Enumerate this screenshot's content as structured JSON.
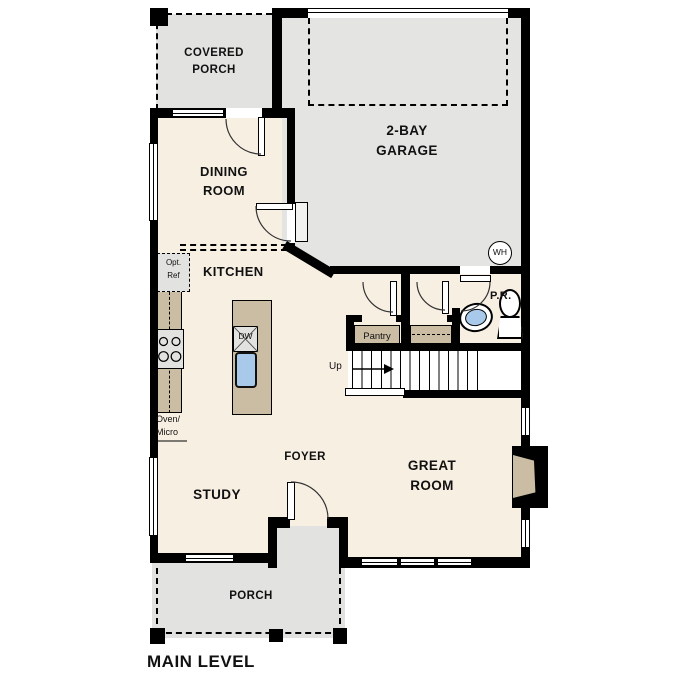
{
  "title": "MAIN LEVEL",
  "rooms": {
    "covered_porch": {
      "line1": "COVERED",
      "line2": "PORCH"
    },
    "garage": {
      "line1": "2-BAY",
      "line2": "GARAGE"
    },
    "dining": {
      "line1": "DINING",
      "line2": "ROOM"
    },
    "kitchen": {
      "label": "KITCHEN"
    },
    "pantry": {
      "label": "Pantry"
    },
    "powder_room": {
      "label": "P.R."
    },
    "foyer": {
      "label": "FOYER"
    },
    "study": {
      "label": "STUDY"
    },
    "great_room": {
      "line1": "GREAT",
      "line2": "ROOM"
    },
    "porch": {
      "label": "PORCH"
    }
  },
  "annotations": {
    "up": "Up",
    "water_heater": "WH",
    "dishwasher": "DW",
    "opt_ref_line1": "Opt.",
    "opt_ref_line2": "Ref",
    "oven_micro_line1": "Oven/",
    "oven_micro_line2": "Micro"
  },
  "colors": {
    "floor": "#f8efe3",
    "porch": "#e2e2e0",
    "garage": "#e4e4e2",
    "wall": "#000000",
    "cabinet": "#cbbda4",
    "sink_blue": "#a9c9ea"
  }
}
